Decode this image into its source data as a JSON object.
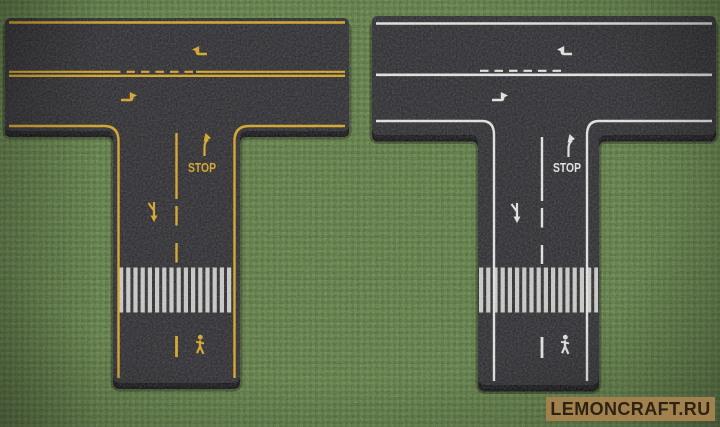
{
  "watermark": {
    "text": "LEMONCRAFT.RU",
    "background": "#a1824f",
    "color": "#2e2312"
  },
  "colors": {
    "grass": "#587a3a",
    "asphalt": "#28282c",
    "asphalt_side": "#121215",
    "crosswalk": "#d8d8d4"
  },
  "roads": [
    {
      "name": "yellow-marked-t-intersection",
      "marking_color": "#d9a51f",
      "stop_label": "STOP",
      "symbols": [
        "left-turn-arrow",
        "right-turn-arrow",
        "right-turn-lane-arrow",
        "stop-text",
        "merge-arrow",
        "lane-dash-line",
        "crosswalk",
        "pedestrian-symbol"
      ]
    },
    {
      "name": "white-marked-t-intersection",
      "marking_color": "#e6e6e3",
      "stop_label": "STOP",
      "symbols": [
        "left-turn-arrow",
        "right-turn-arrow",
        "right-turn-lane-arrow",
        "stop-text",
        "merge-arrow",
        "lane-dash-line",
        "crosswalk",
        "pedestrian-symbol"
      ]
    }
  ]
}
